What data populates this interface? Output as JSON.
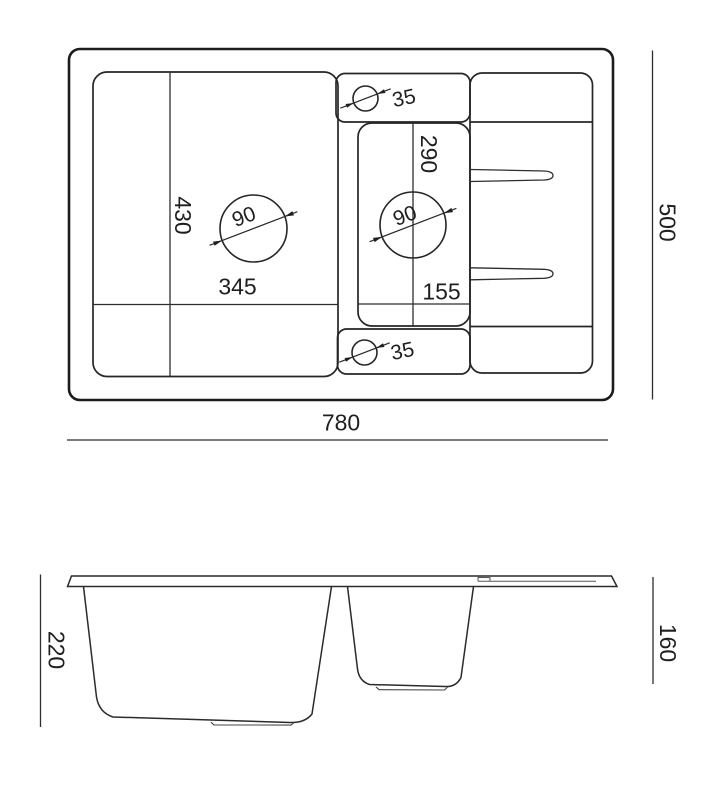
{
  "drawing": {
    "top_view": {
      "overall_width": "780",
      "overall_height": "500",
      "main_bowl_width": "345",
      "main_bowl_height": "430",
      "main_drain_diameter": "90",
      "small_bowl_width": "155",
      "small_bowl_height": "290",
      "small_drain_diameter": "90",
      "tap_hole_top_diameter": "35",
      "tap_hole_bottom_diameter": "35"
    },
    "side_view": {
      "main_bowl_depth": "220",
      "small_bowl_depth": "160"
    },
    "colors": {
      "line": "#1f1f1f",
      "background": "#ffffff"
    }
  }
}
